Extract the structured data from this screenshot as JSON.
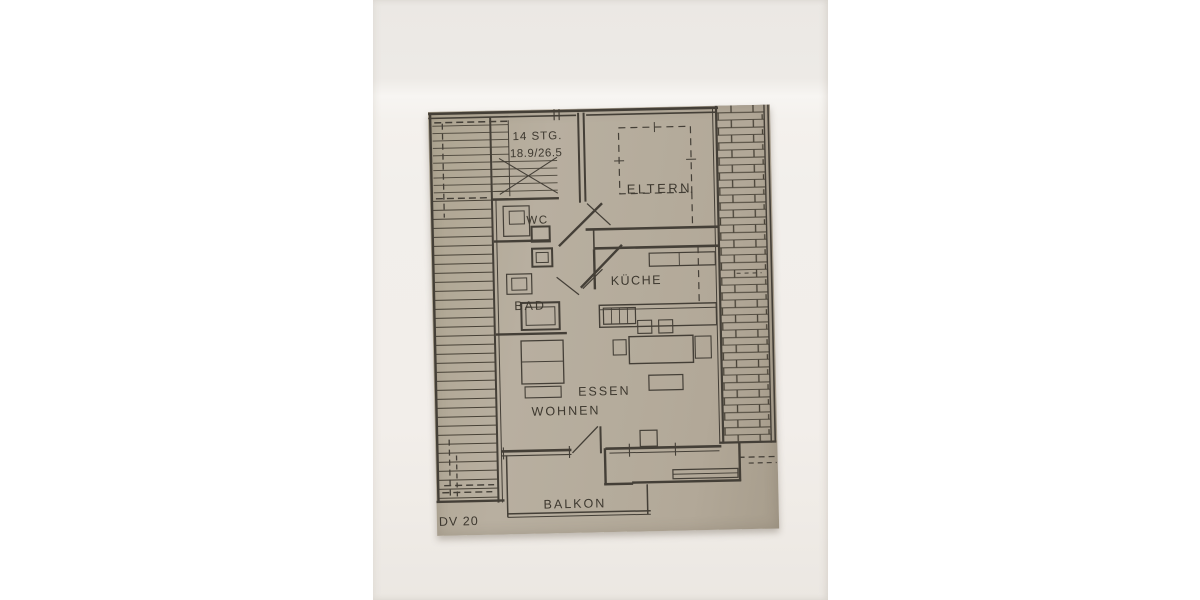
{
  "floor_plan": {
    "annotations": {
      "stairs_line1": "14 STG.",
      "stairs_line2": "18.9/26.5",
      "sheet_code": "DV 20"
    },
    "rooms": [
      {
        "key": "eltern",
        "label": "ELTERN"
      },
      {
        "key": "wc",
        "label": "WC"
      },
      {
        "key": "bad",
        "label": "BAD"
      },
      {
        "key": "kueche",
        "label": "KÜCHE"
      },
      {
        "key": "essen",
        "label": "ESSEN"
      },
      {
        "key": "wohnen",
        "label": "WOHNEN"
      },
      {
        "key": "balkon",
        "label": "BALKON"
      }
    ],
    "colors": {
      "page_background": "#ffffff",
      "photo_paper": "#f2efeb",
      "scan_paper": "#b3aa9a",
      "ink": "#443f37"
    }
  }
}
